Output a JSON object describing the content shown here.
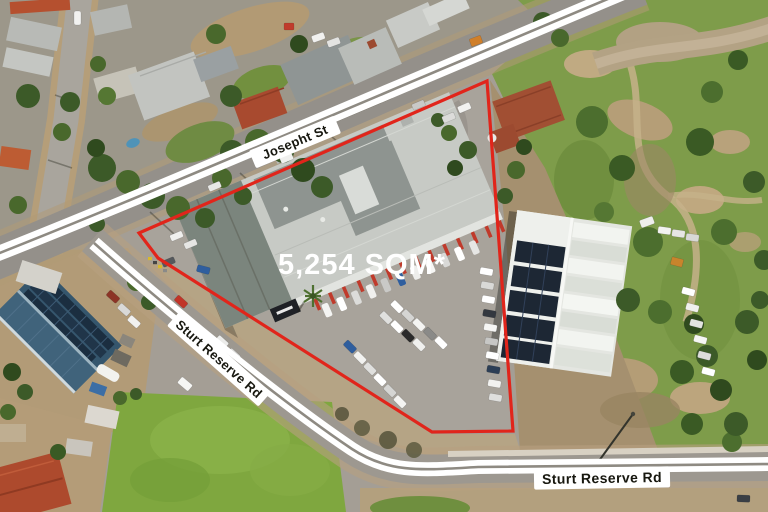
{
  "annotation": {
    "area_label": "5,254 SQM*",
    "streets": {
      "josepht": "Josepht St",
      "sturt_reserve_diagonal": "Sturt Reserve Rd",
      "sturt_reserve_horizontal": "Sturt Reserve Rd"
    },
    "colors": {
      "boundary": "#e1251b",
      "road_band": "#ffffff",
      "street_label_text": "#17170f",
      "area_label_text": "#ffffff"
    }
  }
}
